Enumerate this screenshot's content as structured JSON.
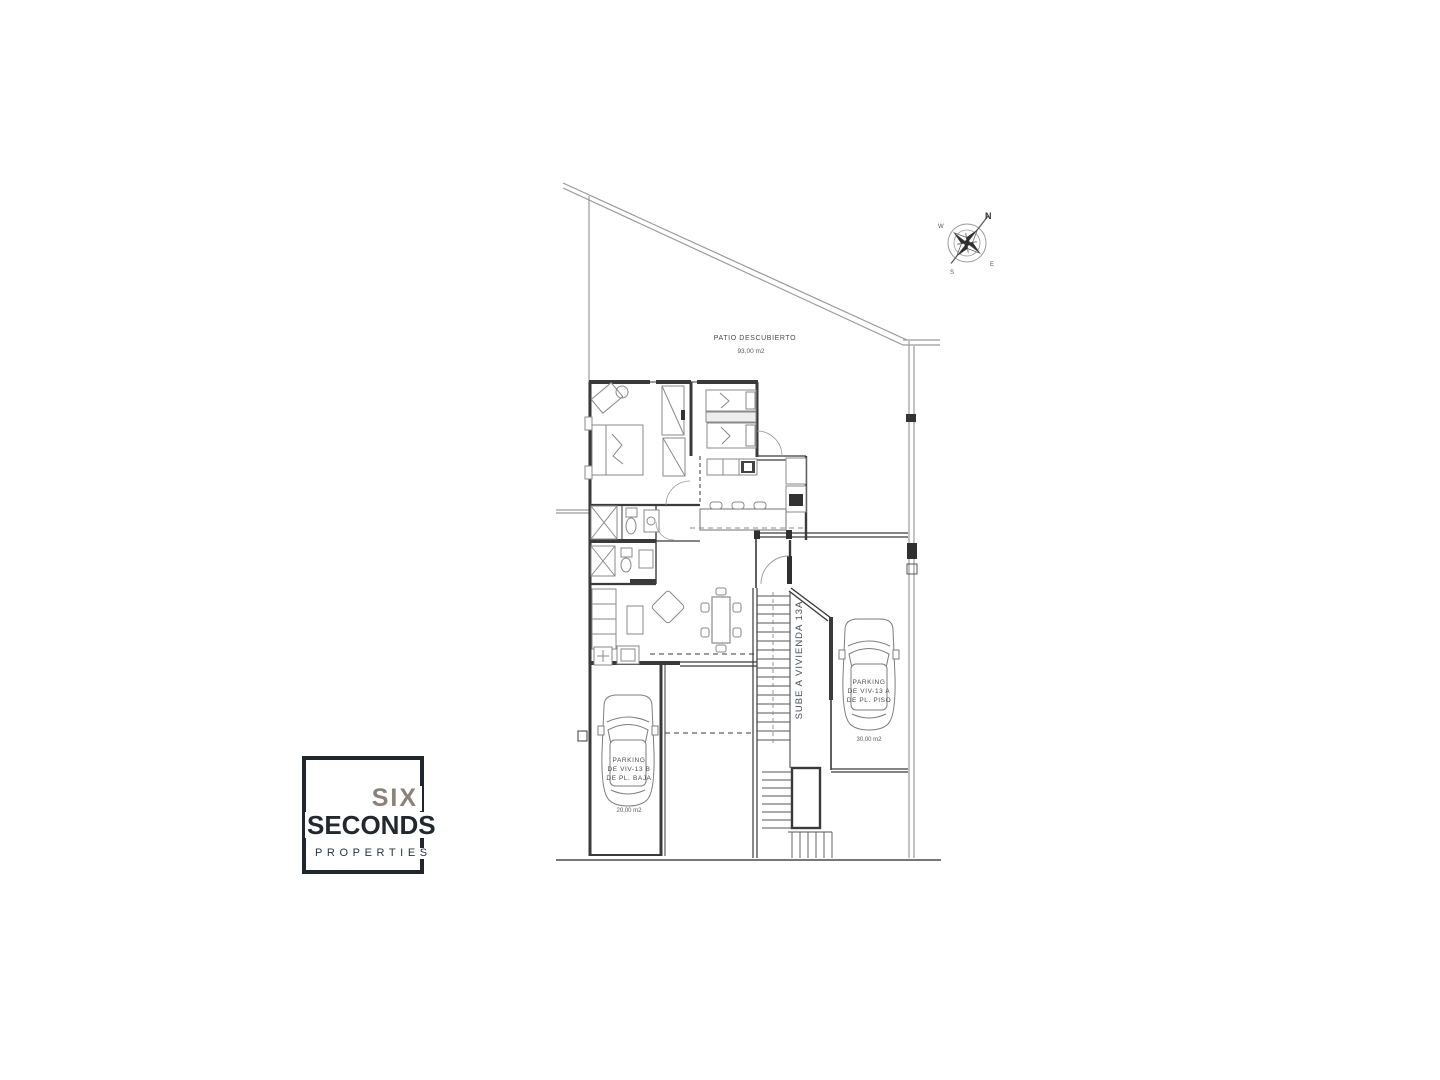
{
  "plan": {
    "patio": {
      "label": "PATIO DESCUBIERTO",
      "area": "93,00 m2"
    },
    "stairs": {
      "label": "SUBE A VIVIENDA 13A"
    },
    "parking_a": {
      "line1": "PARKING",
      "line2": "DE VIV-13 A",
      "line3": "DE PL. PISO",
      "area": "30,00 m2"
    },
    "parking_b": {
      "line1": "PARKING",
      "line2": "DE VIV-13 B",
      "line3": "DE PL. BAJA",
      "area": "20,00 m2"
    },
    "compass": {
      "n": "N",
      "e": "E",
      "s": "S",
      "w": "W"
    }
  },
  "logo": {
    "line1": "SIX",
    "line2": "SECONDS",
    "line3": "PROPERTIES"
  },
  "colors": {
    "wall": "#3a3a3a",
    "boundary": "#8f8f8f",
    "furniture": "#8a8a8a",
    "logo_dark": "#20262e",
    "logo_gray": "#8b8177",
    "stair_text": "#44505b"
  }
}
